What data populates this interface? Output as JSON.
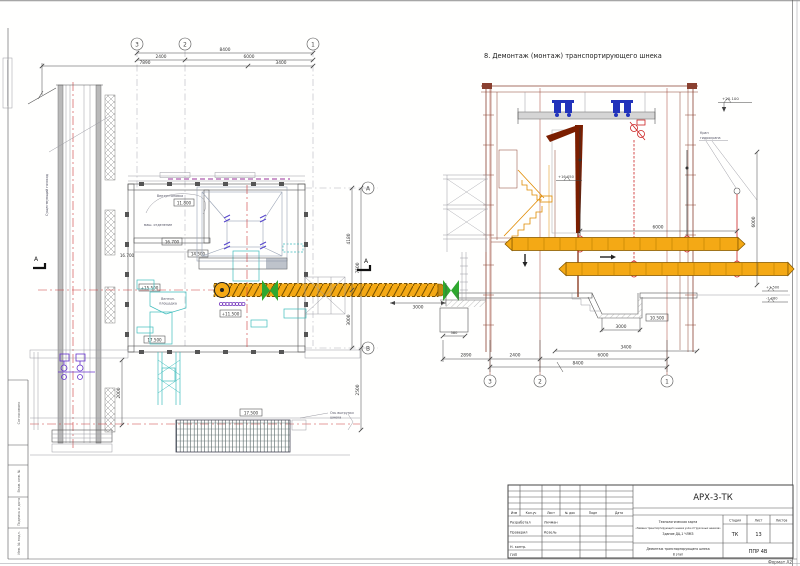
{
  "sheet": {
    "stamp": {
      "agreed": "Согласовано",
      "vzam": "Взам. инв. №",
      "sign": "Подпись и дата",
      "inv": "Инв. № подл."
    },
    "format": "Формат А2"
  },
  "section_title": "8. Демонтаж (монтаж) транспортирующего шнека",
  "plan": {
    "axes": {
      "a3": "3",
      "a2": "2",
      "a1": "1",
      "aA": "А",
      "aB": "В"
    },
    "dims": {
      "top_8400": "8400",
      "top_2400": "2400",
      "top_6000": "6000",
      "top_7890": "7890",
      "top_3400": "3400",
      "right_4180": "4180",
      "right_7500": "7500",
      "right_3000": "3000",
      "right_2500": "2500",
      "v_2000": "2000",
      "out_3000": "3000"
    },
    "elev": {
      "e_11800": "11.800",
      "e_16700": "16.700",
      "e_16700b": "16.700",
      "e_14500": "14.500",
      "e_15500": "+15.500",
      "e_11500": "+11.500",
      "e_17500": "17.500",
      "e_17500b": "17.500"
    },
    "labels": {
      "vent": "Вентустановка",
      "mash": "маш. отделение",
      "pl1": "Вентил.",
      "pl2": "площадка",
      "note1": "Ось выгрузки",
      "note2": "шнека",
      "annot": "Существующий газоход",
      "sec": "А"
    }
  },
  "sec": {
    "crane1": "Кран",
    "crane2": "гидрокрана",
    "elev": {
      "top": "+20.100",
      "mid": "+16.050",
      "pit": "10.500",
      "r1": "+1.500",
      "r2": "-1.280"
    },
    "dims": {
      "h6000": "6000",
      "v6000": "6000",
      "pit3000": "3000",
      "d580": "580",
      "b2890": "2890",
      "b2400": "2400",
      "b6000": "6000",
      "b3400": "3400",
      "b8400": "8400"
    },
    "axes": {
      "a3": "3",
      "a2": "2",
      "a1": "1"
    }
  },
  "tb": {
    "code": "АРХ-3-ТК",
    "cols": [
      "Изм",
      "Кол.уч",
      "Лист",
      "№ док",
      "Подп",
      "Дата"
    ],
    "r1l": "Разработал",
    "r1v": "Личман",
    "r2l": "Проверил",
    "r2v": "Козель",
    "r3l": "Н. контр.",
    "r4l": "ГИП",
    "proj1": "Технологическая карта",
    "proj2": "«Замена транспортирующего шнека узла отгрузочных шнеков»",
    "proj3": "Здание ДЦ-1 ЧЛМЗ",
    "stage": [
      "Стадия",
      "Лист",
      "Листов"
    ],
    "stage_v": "ТК",
    "list_v": "13",
    "name1": "Демонтаж транспортирующего шнека",
    "name2": "8 этап",
    "doc": "ППР 4В",
    "format": "Формат А2"
  }
}
